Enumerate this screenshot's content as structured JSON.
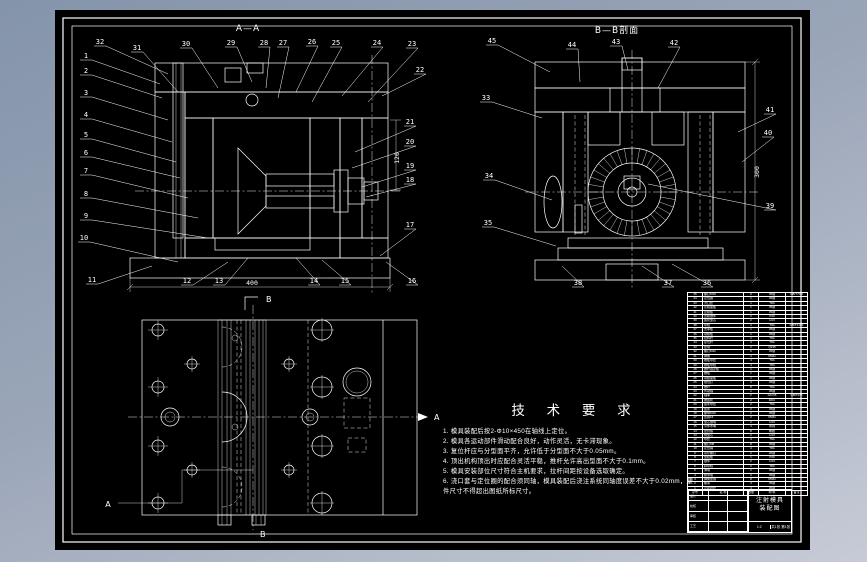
{
  "colors": {
    "background_top": "#8494aa",
    "background_bottom": "#c6cbd6",
    "canvas": "#000000",
    "line": "#ffffff"
  },
  "drawing": {
    "view_aa": {
      "title": "A—A",
      "callouts": [
        "32",
        "1",
        "2",
        "3",
        "4",
        "5",
        "6",
        "7",
        "8",
        "9",
        "10",
        "11",
        "31",
        "30",
        "29",
        "28",
        "27",
        "26",
        "25",
        "24",
        "23",
        "22",
        "21",
        "20",
        "19",
        "18",
        "17",
        "16",
        "12",
        "13",
        "14",
        "15"
      ],
      "dim_width": "400",
      "dim_height": "120",
      "marker_b": "B"
    },
    "view_bb": {
      "title": "B—B剖面",
      "callouts": [
        "45",
        "44",
        "43",
        "42",
        "33",
        "34",
        "35",
        "41",
        "40",
        "39",
        "38",
        "37",
        "36"
      ],
      "dim_height": "300"
    },
    "plan": {
      "marker_a_left": "A",
      "marker_a_right": "A",
      "marker_b_top": "B",
      "marker_b_bottom": "B"
    }
  },
  "tech_requirements": {
    "title": "技 术 要 求",
    "items": [
      "1. 模具装配后按2-Φ10×450在轴线上定位。",
      "2. 模具各运动部件滑动配合良好，动作灵活，无卡滞现象。",
      "3. 复位杆应与分型面平齐，允许低于分型面不大于0.05mm。",
      "4. 顶出机构顶出时应配合灵活平稳，推杆允许高出型面不大于0.1mm。",
      "5. 模具安装部位尺寸符合主机要求，拉杆间距按设备选取确定。",
      "6. 浇口套与定位圈的配合须同轴，模具装配后浇注系统同轴度误差不大于0.02mm，塑件尺寸不得超出图纸所标尺寸。"
    ]
  },
  "bom": {
    "headers": [
      "序号",
      "名  称",
      "数量",
      "材 料",
      "备注"
    ],
    "rows": [
      [
        "45",
        "螺钉M10",
        "6",
        "45钢",
        "GB/T70.1"
      ],
      [
        "44",
        "定位圈",
        "1",
        "45钢",
        ""
      ],
      [
        "43",
        "浇口套",
        "1",
        "T8A",
        ""
      ],
      [
        "42",
        "定模座板",
        "1",
        "45钢",
        ""
      ],
      [
        "41",
        "定模板",
        "1",
        "45钢",
        ""
      ],
      [
        "40",
        "凹模镶件",
        "2",
        "P20",
        ""
      ],
      [
        "39",
        "齿轮型芯",
        "2",
        "H13",
        ""
      ],
      [
        "38",
        "导柱",
        "4",
        "T8A",
        "GB/T4169"
      ],
      [
        "37",
        "支承板",
        "1",
        "45钢",
        ""
      ],
      [
        "36",
        "动模板",
        "1",
        "45钢",
        ""
      ],
      [
        "35",
        "拉料杆",
        "1",
        "T8A",
        ""
      ],
      [
        "34",
        "复位杆",
        "4",
        "T8A",
        ""
      ],
      [
        "33",
        "垫块",
        "2",
        "Q235",
        ""
      ],
      [
        "32",
        "螺钉M12",
        "6",
        "45钢",
        ""
      ],
      [
        "31",
        "弹簧",
        "4",
        "65Mn",
        ""
      ],
      [
        "30",
        "推板导套",
        "4",
        "T8A",
        ""
      ],
      [
        "29",
        "推板导柱",
        "4",
        "T8A",
        ""
      ],
      [
        "28",
        "推杆固定板",
        "1",
        "45钢",
        ""
      ],
      [
        "27",
        "推板",
        "1",
        "45钢",
        ""
      ],
      [
        "26",
        "动模座板",
        "1",
        "45钢",
        ""
      ],
      [
        "25",
        "限位钉",
        "4",
        "45钢",
        ""
      ],
      [
        "24",
        "推杆",
        "8",
        "T8A",
        ""
      ],
      [
        "23",
        "传动轴",
        "1",
        "45钢",
        ""
      ],
      [
        "22",
        "轴承",
        "2",
        "GCr15",
        "GB/T276"
      ],
      [
        "21",
        "锥齿轮",
        "2",
        "40Cr",
        ""
      ],
      [
        "20",
        "齿条导套",
        "2",
        "T8A",
        ""
      ],
      [
        "19",
        "齿条",
        "2",
        "45钢",
        ""
      ],
      [
        "18",
        "螺母M16",
        "2",
        "45钢",
        ""
      ],
      [
        "17",
        "垫圈16",
        "2",
        "65Mn",
        ""
      ],
      [
        "16",
        "型芯镶块",
        "2",
        "H13",
        ""
      ],
      [
        "15",
        "冷却水嘴",
        "4",
        "黄铜",
        ""
      ],
      [
        "14",
        "密封圈",
        "8",
        "橡胶",
        ""
      ],
      [
        "13",
        "侧型芯",
        "2",
        "H13",
        ""
      ],
      [
        "12",
        "导套",
        "4",
        "T8A",
        ""
      ],
      [
        "11",
        "螺钉M8",
        "8",
        "45钢",
        ""
      ],
      [
        "10",
        "定位销",
        "4",
        "T8A",
        ""
      ],
      [
        "9",
        "吊环螺钉",
        "2",
        "20钢",
        ""
      ],
      [
        "8",
        "型腔板",
        "1",
        "P20",
        ""
      ],
      [
        "7",
        "镶件",
        "2",
        "H13",
        ""
      ],
      [
        "6",
        "斜导柱",
        "2",
        "T8A",
        ""
      ],
      [
        "5",
        "滑块",
        "2",
        "45钢",
        ""
      ],
      [
        "4",
        "楔紧块",
        "2",
        "45钢",
        ""
      ],
      [
        "3",
        "弹簧垫圈",
        "8",
        "65Mn",
        ""
      ],
      [
        "2",
        "螺塞",
        "4",
        "45钢",
        ""
      ],
      [
        "1",
        "定距拉杆",
        "4",
        "45钢",
        ""
      ]
    ]
  },
  "title_block": {
    "left_rows": [
      [
        "设计",
        "",
        ""
      ],
      [
        "校核",
        "",
        ""
      ],
      [
        "审核",
        "",
        ""
      ],
      [
        "工艺",
        "",
        ""
      ]
    ],
    "title_line1": "注射模具",
    "title_line2": "装配图",
    "scale": "1:2",
    "sheets": "共1张 第1张"
  }
}
